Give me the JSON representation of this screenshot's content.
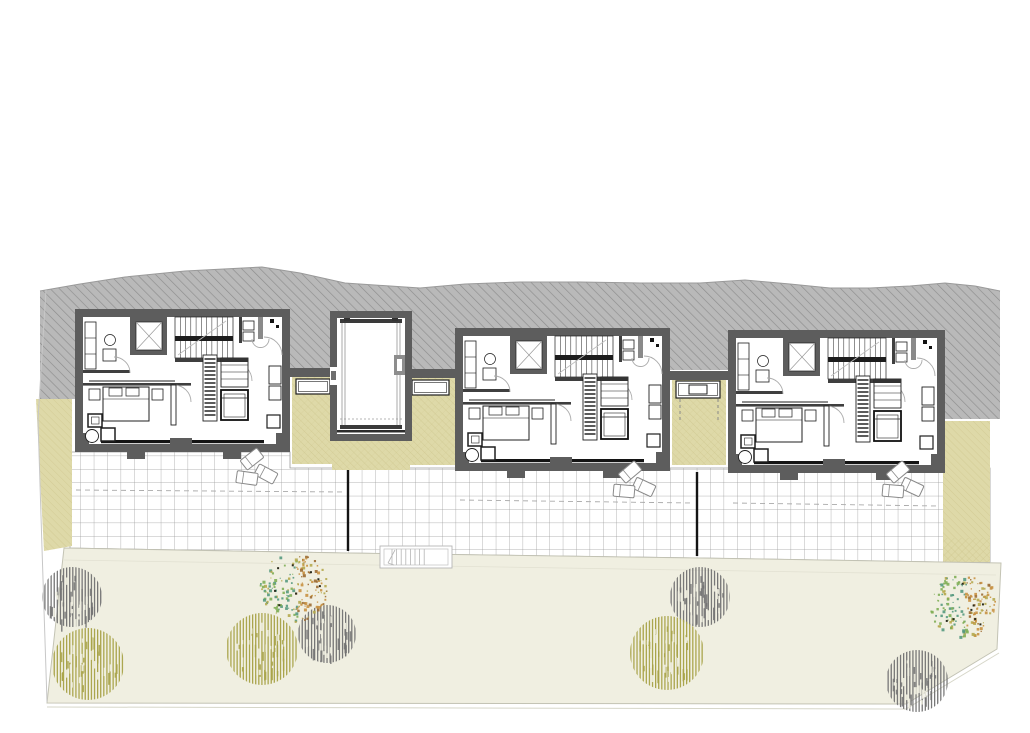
{
  "meta": {
    "kind": "architectural floor plan",
    "description": "Upper-level plan of three identical row houses cut into a hillside, with a central stair-lift core, khaki light wells, tiled terraces with loungers, and a lawn garden with trees"
  },
  "palette": {
    "paper": "#ffffff",
    "hatch_fill": "#b9b9b9",
    "hatch_line": "#8d8d8d",
    "hatch_edge": "#9a9a9a",
    "wall": "#5d5d5d",
    "wall_dark": "#3f3f3f",
    "line": "#1f1f1f",
    "soft_line": "#9a9a9a",
    "door_arc": "#ababab",
    "khaki_fill": "#ded9a8",
    "khaki_line": "#cdc58d",
    "grid_line": "#9c9c9c",
    "divider": "#141414",
    "dash_line": "#a9a9a9",
    "garden_fill": "#f0efe1",
    "garden_edge": "#c3c3b4",
    "tree_gray": "#737373",
    "tree_olive": "#a8a348",
    "speckles": [
      "#7fae57",
      "#55997f",
      "#b5a94e",
      "#c89143",
      "#9c6b33",
      "#4f6b3a"
    ]
  },
  "buildings": {
    "units": [
      {
        "id": "unit-1",
        "x": 75,
        "y": 309,
        "w": 215,
        "h": 143
      },
      {
        "id": "unit-2",
        "x": 455,
        "y": 328,
        "w": 215,
        "h": 143
      },
      {
        "id": "unit-3",
        "x": 728,
        "y": 330,
        "w": 217,
        "h": 143
      }
    ],
    "core": {
      "id": "stair-lift-core",
      "x": 330,
      "y": 311,
      "w": 82,
      "h": 130
    }
  },
  "courtyards": [
    {
      "id": "lightwell-left",
      "x": 292,
      "y": 368,
      "w": 45,
      "h": 96,
      "wall": {
        "x": 290,
        "y": 368,
        "w": 47,
        "h": 9
      },
      "planter": {
        "x": 296,
        "y": 379,
        "w": 34,
        "h": 15,
        "inner": false
      },
      "dashes": false
    },
    {
      "id": "lightwell-right",
      "x": 407,
      "y": 369,
      "w": 48,
      "h": 96,
      "wall": {
        "x": 405,
        "y": 369,
        "w": 50,
        "h": 9
      },
      "planter": {
        "x": 412,
        "y": 380,
        "w": 37,
        "h": 15,
        "inner": false
      },
      "dashes": false
    },
    {
      "id": "core-forecourt",
      "x": 332,
      "y": 437,
      "w": 78,
      "h": 33,
      "wall": null,
      "planter": null,
      "dashes": false
    },
    {
      "id": "lightwell-mid",
      "x": 672,
      "y": 371,
      "w": 54,
      "h": 94,
      "wall": {
        "x": 670,
        "y": 371,
        "w": 58,
        "h": 9
      },
      "planter": {
        "x": 676,
        "y": 381,
        "w": 44,
        "h": 17,
        "inner": true
      },
      "dashes": true
    }
  ],
  "terrace": {
    "dividers": [
      {
        "x": 348,
        "y1": 470,
        "y2": 551
      },
      {
        "x": 697,
        "y1": 472,
        "y2": 556
      }
    ],
    "dashed_lines": [
      {
        "x1": 76,
        "y1": 490,
        "x2": 344,
        "y2": 492
      },
      {
        "x1": 460,
        "y1": 500,
        "x2": 693,
        "y2": 503
      },
      {
        "x1": 733,
        "y1": 503,
        "x2": 938,
        "y2": 506
      }
    ],
    "loungers": [
      {
        "x": 252,
        "y": 459,
        "rot": -38
      },
      {
        "x": 266,
        "y": 474,
        "rot": 28
      },
      {
        "x": 247,
        "y": 478,
        "rot": 8
      },
      {
        "x": 630,
        "y": 472,
        "rot": -40
      },
      {
        "x": 644,
        "y": 487,
        "rot": 25
      },
      {
        "x": 624,
        "y": 491,
        "rot": 5
      },
      {
        "x": 898,
        "y": 472,
        "rot": -40
      },
      {
        "x": 912,
        "y": 487,
        "rot": 25
      },
      {
        "x": 893,
        "y": 491,
        "rot": 5
      }
    ]
  },
  "garden": {
    "trees": [
      {
        "type": "gray",
        "cx": 72,
        "cy": 597,
        "r": 30
      },
      {
        "type": "olive",
        "cx": 88,
        "cy": 664,
        "r": 36
      },
      {
        "type": "olive",
        "cx": 262,
        "cy": 649,
        "r": 36
      },
      {
        "type": "gray",
        "cx": 327,
        "cy": 634,
        "r": 29
      },
      {
        "type": "speckled",
        "cx": 293,
        "cy": 587,
        "r": 33
      },
      {
        "type": "gray",
        "cx": 700,
        "cy": 597,
        "r": 30
      },
      {
        "type": "olive",
        "cx": 667,
        "cy": 653,
        "r": 37
      },
      {
        "type": "speckled",
        "cx": 963,
        "cy": 604,
        "r": 32
      },
      {
        "type": "gray",
        "cx": 917,
        "cy": 681,
        "r": 31
      }
    ],
    "stair": {
      "x": 380,
      "y": 546,
      "w": 72,
      "h": 22
    }
  }
}
